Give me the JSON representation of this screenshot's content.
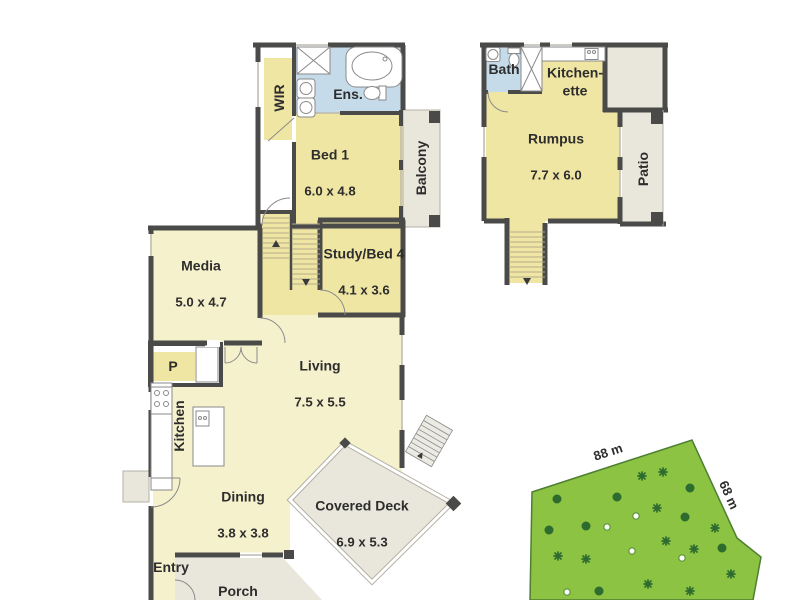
{
  "rooms": {
    "wir": {
      "name": "WIR"
    },
    "ens": {
      "name": "Ens."
    },
    "bed1": {
      "name": "Bed 1",
      "dims": "6.0 x 4.8"
    },
    "balcony": {
      "name": "Balcony"
    },
    "media": {
      "name": "Media",
      "dims": "5.0 x 4.7"
    },
    "study": {
      "name": "Study/Bed 4",
      "dims": "4.1 x 3.6"
    },
    "living": {
      "name": "Living",
      "dims": "7.5 x 5.5"
    },
    "pantry": {
      "name": "P"
    },
    "kitchen": {
      "name": "Kitchen"
    },
    "dining": {
      "name": "Dining",
      "dims": "3.8 x 3.8"
    },
    "covered_deck": {
      "name": "Covered Deck",
      "dims": "6.9 x 5.3"
    },
    "entry": {
      "name": "Entry"
    },
    "porch": {
      "name": "Porch"
    },
    "bath": {
      "name": "Bath"
    },
    "kitchenette": {
      "name": "Kitchen-\nette"
    },
    "rumpus": {
      "name": "Rumpus",
      "dims": "7.7 x 6.0"
    },
    "patio": {
      "name": "Patio"
    }
  },
  "land": {
    "top_edge": "88 m",
    "right_edge": "68 m"
  },
  "colors": {
    "wall": "#4a4a48",
    "room-yellow": "#f0e6a4",
    "room-cream": "#f6f1cd",
    "room-blue": "#c6dbe9",
    "outdoor-gray": "#e9e7dc",
    "land-green": "#8cc342",
    "land-border": "#4e7e33",
    "tree-green": "#2d6b2f",
    "label-text": "#2d2d2d"
  }
}
